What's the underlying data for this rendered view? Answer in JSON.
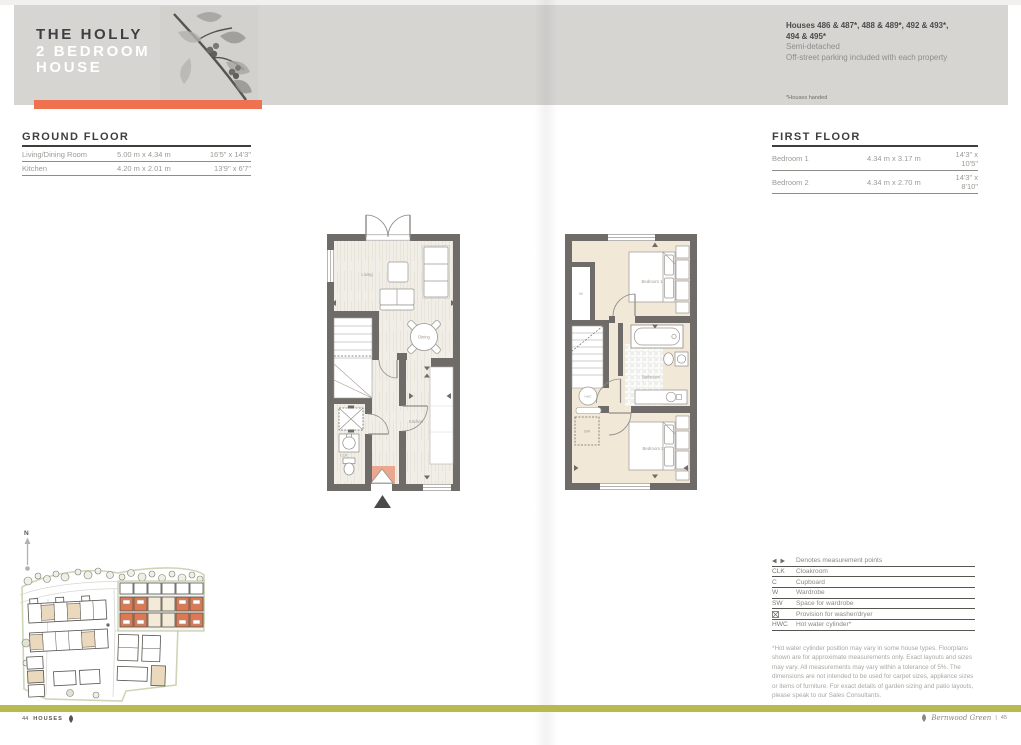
{
  "header": {
    "title": "THE HOLLY",
    "subtitle_line1": "2 BEDROOM",
    "subtitle_line2": "HOUSE",
    "accent_color": "#ee7150",
    "houses_line1": "Houses 486 & 487*, 488 & 489*, 492 & 493*,",
    "houses_line2": "494 & 495*",
    "detail_line1": "Semi-detached",
    "detail_line2": "Off-street parking included with each property",
    "footnote": "*Houses handed"
  },
  "ground_floor": {
    "heading": "GROUND FLOOR",
    "rows": [
      {
        "room": "Living/Dining Room",
        "metric": "5.00 m x 4.34 m",
        "imperial": "16'5\" x 14'3\""
      },
      {
        "room": "Kitchen",
        "metric": "4.20 m x 2.01 m",
        "imperial": "13'9\" x 6'7\""
      }
    ]
  },
  "first_floor": {
    "heading": "FIRST FLOOR",
    "rows": [
      {
        "room": "Bedroom 1",
        "metric": "4.34 m x 3.17 m",
        "imperial": "14'3\" x 10'5\""
      },
      {
        "room": "Bedroom 2",
        "metric": "4.34 m x 2.70 m",
        "imperial": "14'3\" x 8'10\""
      }
    ]
  },
  "floorplans": {
    "ground": {
      "living": "Living",
      "dining": "Dining",
      "kitchen": "Kitchen",
      "clk": "CLK"
    },
    "first": {
      "bedroom1": "Bedroom 1",
      "bathroom": "Bathroom",
      "bedroom2": "Bedroom 2",
      "wardrobe": "W",
      "sw": "SW",
      "hwc": "HWC"
    }
  },
  "site_plan": {
    "north_label": "N",
    "highlight_color": "#dd7952"
  },
  "legend": {
    "rows": [
      {
        "symbol": "",
        "icon": "measurement-arrows-icon",
        "label": "Denotes measurement points"
      },
      {
        "symbol": "CLK",
        "label": "Cloakroom"
      },
      {
        "symbol": "C",
        "label": "Cupboard"
      },
      {
        "symbol": "W",
        "label": "Wardrobe"
      },
      {
        "symbol": "SW",
        "label": "Space for wardrobe"
      },
      {
        "symbol": "",
        "icon": "washer-dryer-icon",
        "label": "Provision for washer/dryer"
      },
      {
        "symbol": "HWC",
        "label": "Hot water cylinder*"
      }
    ]
  },
  "disclaimer": "*Hot water cylinder position may vary in some house types. Floorplans shown are for approximate measurements only. Exact layouts and sizes may vary. All measurements may vary within a tolerance of 5%. The dimensions are not intended to be used for carpet sizes, appliance sizes or items of furniture. For exact details of garden sizing and patio layouts, please speak to our Sales Consultants.",
  "footer": {
    "left_page": "44",
    "left_label": "HOUSES",
    "right_name": "Bernwood Green",
    "divider": "|",
    "right_page": "45",
    "bar_color": "#b8b94e"
  }
}
